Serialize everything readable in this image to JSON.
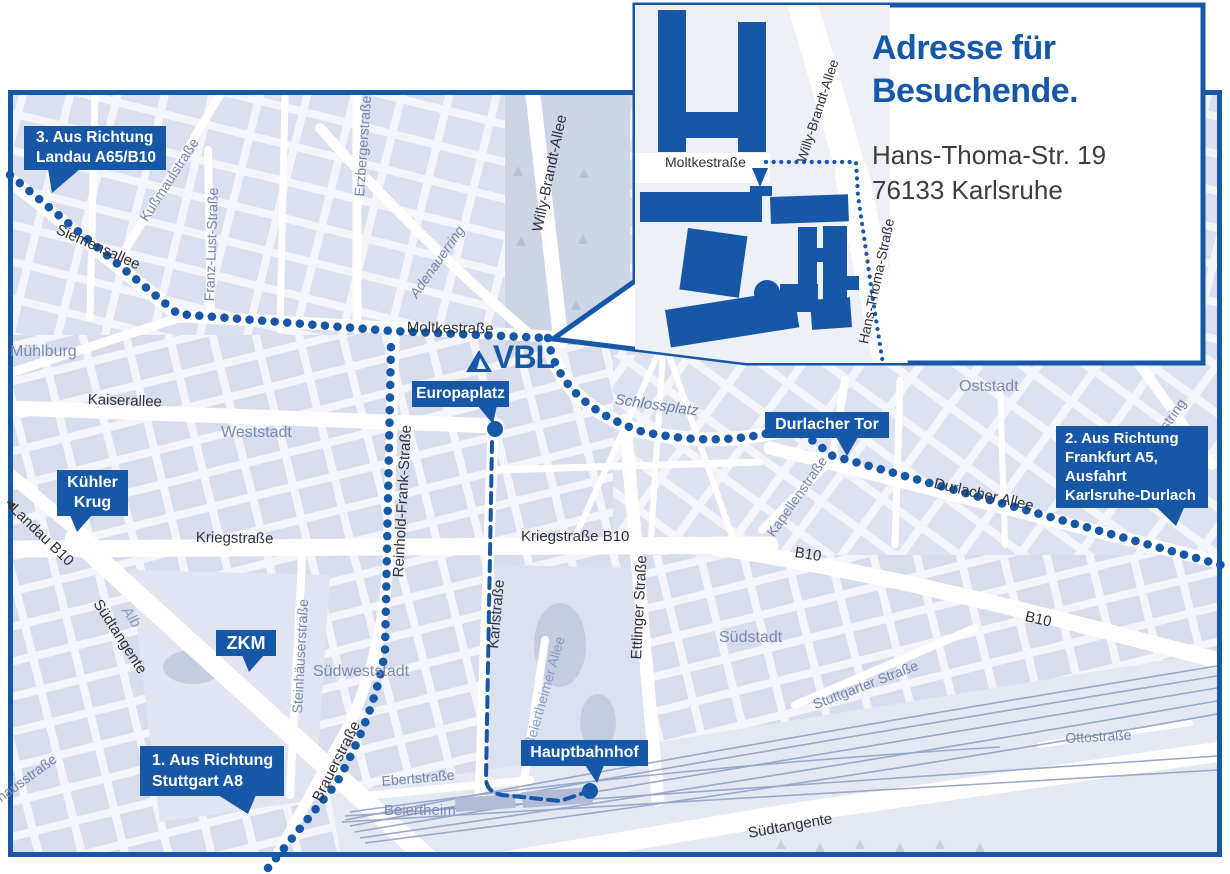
{
  "colors": {
    "accent": "#1658a7",
    "map_background": "#f3f5fa",
    "block_fill": "#dae0ef",
    "park_fill": "#ccd4e5",
    "street_label_dark": "#303239",
    "street_label_blue": "#7684ae",
    "area_label": "#7b89b3",
    "address_text": "#3d3d3d"
  },
  "icons": {
    "west_arrow": "◀",
    "vbl_triangle": "triangle-logo",
    "route_arrow": "▼"
  },
  "logo": {
    "text": "VBL"
  },
  "inset": {
    "title_line1": "Adresse für",
    "title_line2": "Besuchende.",
    "address_line1": "Hans-Thoma-Str. 19",
    "address_line2": "76133 Karlsruhe",
    "streets": {
      "moltkestrasse": "Moltkestraße",
      "willy_brandt_allee": "Willy-Brandt-Allee",
      "hans_thoma_strasse": "Hans-Thoma-Straße"
    }
  },
  "callouts": {
    "landau": {
      "lines": [
        "3. Aus Richtung",
        "Landau A65/B10"
      ]
    },
    "frankfurt": {
      "lines": [
        "2. Aus Richtung",
        "Frankfurt A5,",
        "Ausfahrt",
        "Karlsruhe-Durlach"
      ]
    },
    "stuttgart": {
      "lines": [
        "1. Aus Richtung",
        "Stuttgart A8"
      ]
    },
    "kuehler_krug": {
      "lines": [
        "Kühler",
        "Krug"
      ]
    },
    "zkm": {
      "label": "ZKM"
    },
    "europaplatz": {
      "label": "Europaplatz"
    },
    "durlacher_tor": {
      "label": "Durlacher Tor"
    },
    "hauptbahnhof": {
      "label": "Hauptbahnhof"
    }
  },
  "streets": {
    "siemensallee": "Siemensallee",
    "moltkestrasse": "Moltkestraße",
    "kaiserallee": "Kaiserallee",
    "kriegstrasse": "Kriegstraße",
    "kriegstrasse_b10": "Kriegstraße B10",
    "karlstrasse": "Karlstraße",
    "ettlinger_strasse": "Ettlinger Straße",
    "reinhold_frank_strasse": "Reinhold-Frank-Straße",
    "willy_brandt_allee": "Willy-Brandt-Allee",
    "brauerstrasse": "Brauerstraße",
    "durlacher_allee": "Durlacher Allee",
    "b10": "B10",
    "suedtangente": "Südtangente",
    "landau_b10": "Landau B10",
    "ebertstrasse": "Ebertstraße",
    "kussmaulstrasse": "Kußmaulstraße",
    "franz_lust_strasse": "Franz-Lust-Straße",
    "erzbergerstrasse": "Erzbergerstraße",
    "adenauerring": "Adenauerring",
    "kapellenstrasse": "Kapellenstraße",
    "steinhaeuserstrasse": "Steinhäuserstraße",
    "beiertheimer_allee": "Beiertheimer Allee",
    "stuttgarter_strasse": "Stuttgarter Straße",
    "ostring": "Ostring",
    "ottostrasse": "Ottostraße",
    "pulverhausstrasse": "Pulverhausstraße",
    "alb": "Alb",
    "schlossplatz": "Schlossplatz"
  },
  "areas": {
    "muehlburg": "Mühlburg",
    "weststadt": "Weststadt",
    "oststadt": "Oststadt",
    "suedstadt": "Südstadt",
    "suedweststadt": "Südweststadt",
    "beiertheim": "Beiertheim"
  }
}
